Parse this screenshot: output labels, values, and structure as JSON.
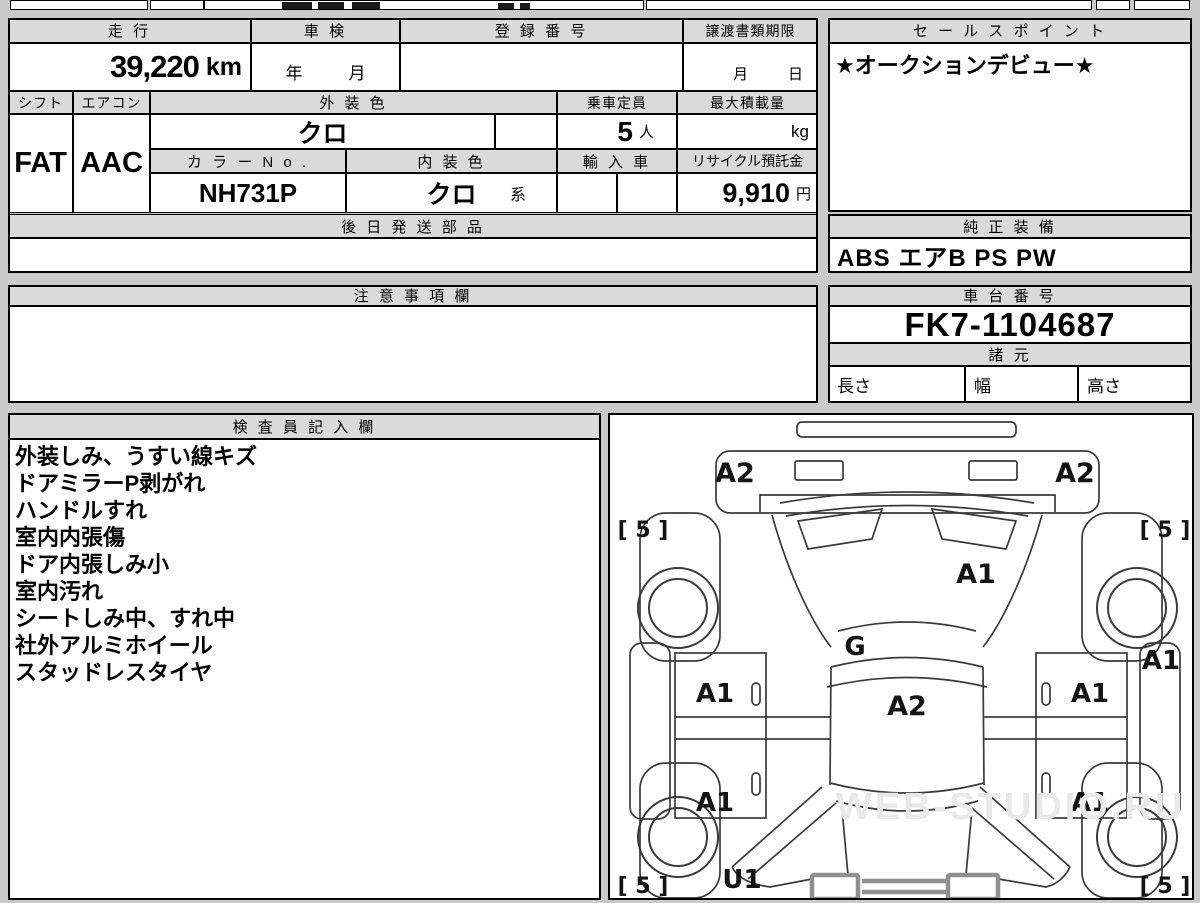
{
  "sheet": {
    "row1": {
      "mileage_label": "走 行",
      "mileage_value": "39,220",
      "mileage_unit": "km",
      "inspection_label": "車 検",
      "inspection_year": "年",
      "inspection_month": "月",
      "registration_label": "登 録 番 号",
      "registration_value": "",
      "transfer_label": "譲渡書類期限",
      "transfer_month": "月",
      "transfer_day": "日"
    },
    "row2": {
      "shift_label": "シフト",
      "shift_value": "FAT",
      "aircon_label": "エアコン",
      "aircon_value": "AAC",
      "exterior_label": "外 装 色",
      "exterior_value": "クロ",
      "capacity_label": "乗車定員",
      "capacity_value": "5",
      "capacity_unit": "人",
      "maxload_label": "最大積載量",
      "maxload_value": "",
      "maxload_unit": "kg"
    },
    "row3": {
      "colorno_label": "カ ラ ー N o .",
      "colorno_value": "NH731P",
      "interior_label": "内 装 色",
      "interior_value": "クロ",
      "interior_suffix": "系",
      "import_label": "輸 入 車",
      "import_value": "",
      "recycle_label": "リサイクル預託金",
      "recycle_value": "9,910",
      "recycle_unit": "円"
    },
    "later_parts": {
      "label": "後 日 発 送 部 品",
      "value": ""
    },
    "sales_point": {
      "label": "セ ー ル ス ポ イ ン ト",
      "value": "★オークションデビュー★"
    },
    "genuine": {
      "label": "純 正 装 備",
      "value": "ABS エアB PS PW"
    },
    "cautions": {
      "label": "注 意 事 項 欄",
      "value": ""
    },
    "chassis": {
      "label": "車 台 番 号",
      "value": "FK7-1104687"
    },
    "specs": {
      "label": "諸 元",
      "length": "長さ",
      "width": "幅",
      "height": "高さ"
    },
    "inspector": {
      "label": "検 査 員 記 入 欄",
      "lines": [
        "外装しみ、うすい線キズ",
        "ドアミラーP剥がれ",
        "ハンドルすれ",
        "室内内張傷",
        "ドア内張しみ小",
        "室内汚れ",
        "シートしみ中、すれ中",
        "社外アルミホイール",
        "スタッドレスタイヤ"
      ]
    },
    "diagram": {
      "front_bumper_left": "A2",
      "front_bumper_right": "A2",
      "tire_front_left": "[ 5 ]",
      "tire_front_right": "[ 5 ]",
      "hood": "A1",
      "cowl": "G",
      "roof": "A2",
      "door_front_left": "A1",
      "door_front_right": "A1",
      "door_rear_left": "A1",
      "door_rear_right": "A1",
      "side_right": "A1",
      "quarter_left": "U1",
      "tire_rear_left": "[ 5 ]",
      "tire_rear_right": "[ 5 ]",
      "watermark": "WEB-STUDIO.RU"
    }
  }
}
